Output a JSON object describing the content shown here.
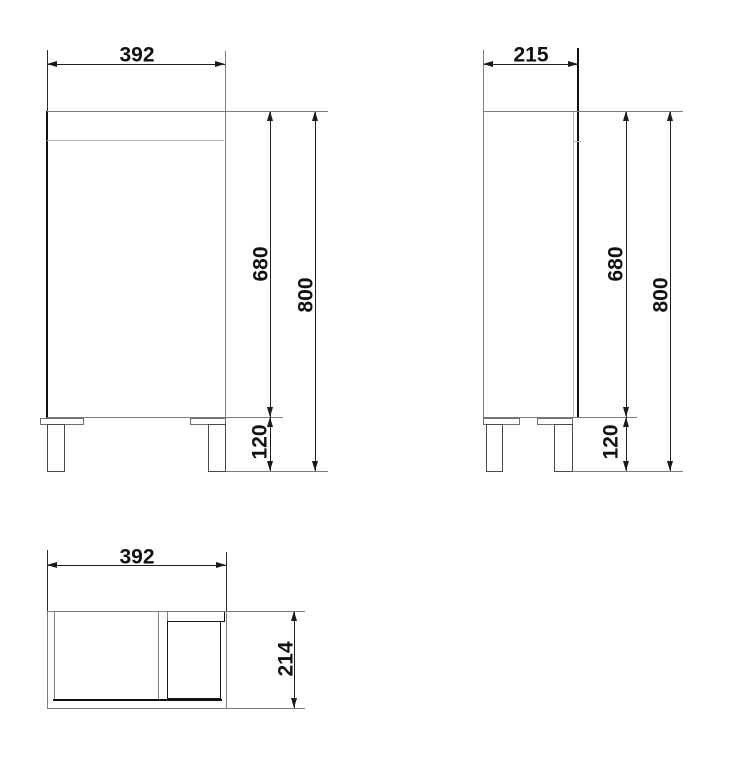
{
  "drawing": {
    "front_view": {
      "width": "392",
      "carcass_height": "680",
      "total_height": "800",
      "leg_height": "120"
    },
    "side_view": {
      "depth": "215",
      "carcass_height": "680",
      "total_height": "800",
      "leg_height": "120"
    },
    "plan_view": {
      "width": "392",
      "depth": "214"
    },
    "colors": {
      "dimension_lines": "#1f1f1f",
      "carcass_lines": "#7d7d7d",
      "light_lines": "#b7b7b7",
      "door_edge_lines": "#101010",
      "background": "#ffffff"
    }
  }
}
